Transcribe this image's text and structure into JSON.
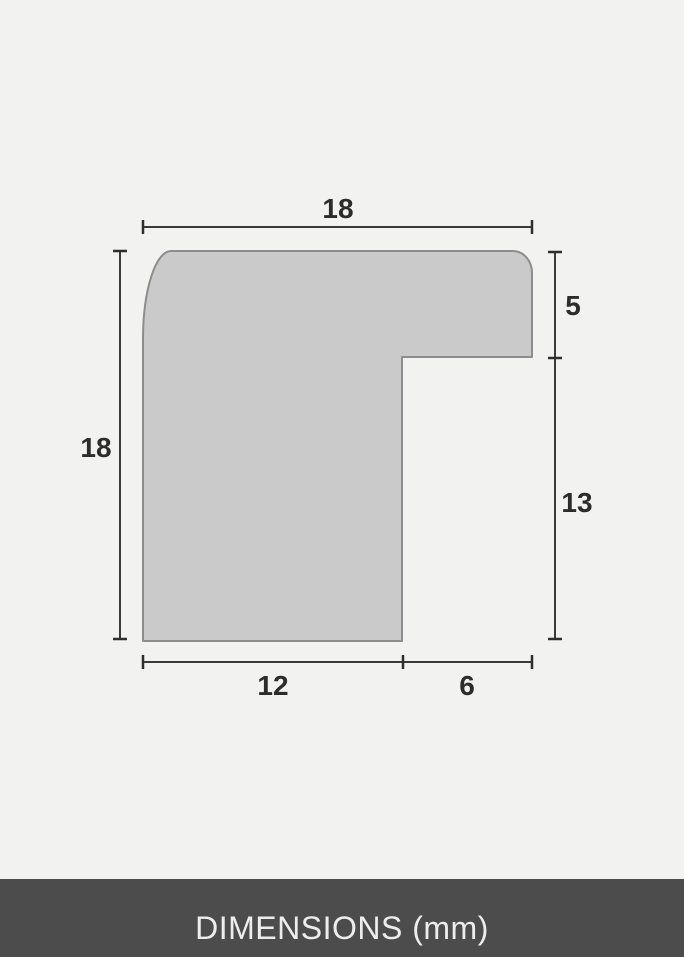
{
  "diagram": {
    "type": "picture-frame-moulding-profile-cross-section",
    "unit_label": "DIMENSIONS (mm)",
    "dimensions": {
      "top_width": "18",
      "left_height": "18",
      "right_upper_depth": "5",
      "right_lower_depth": "13",
      "bottom_left_width": "12",
      "bottom_right_width": "6"
    },
    "colors": {
      "background": "#f2f2f1",
      "shape_fill": "#cacaca",
      "shape_stroke": "#8d8d8d",
      "dimension_line": "#3a3a3a",
      "label_text": "#2c2c2c",
      "footer_background": "#4c4c4c",
      "footer_text": "#ededed"
    }
  }
}
